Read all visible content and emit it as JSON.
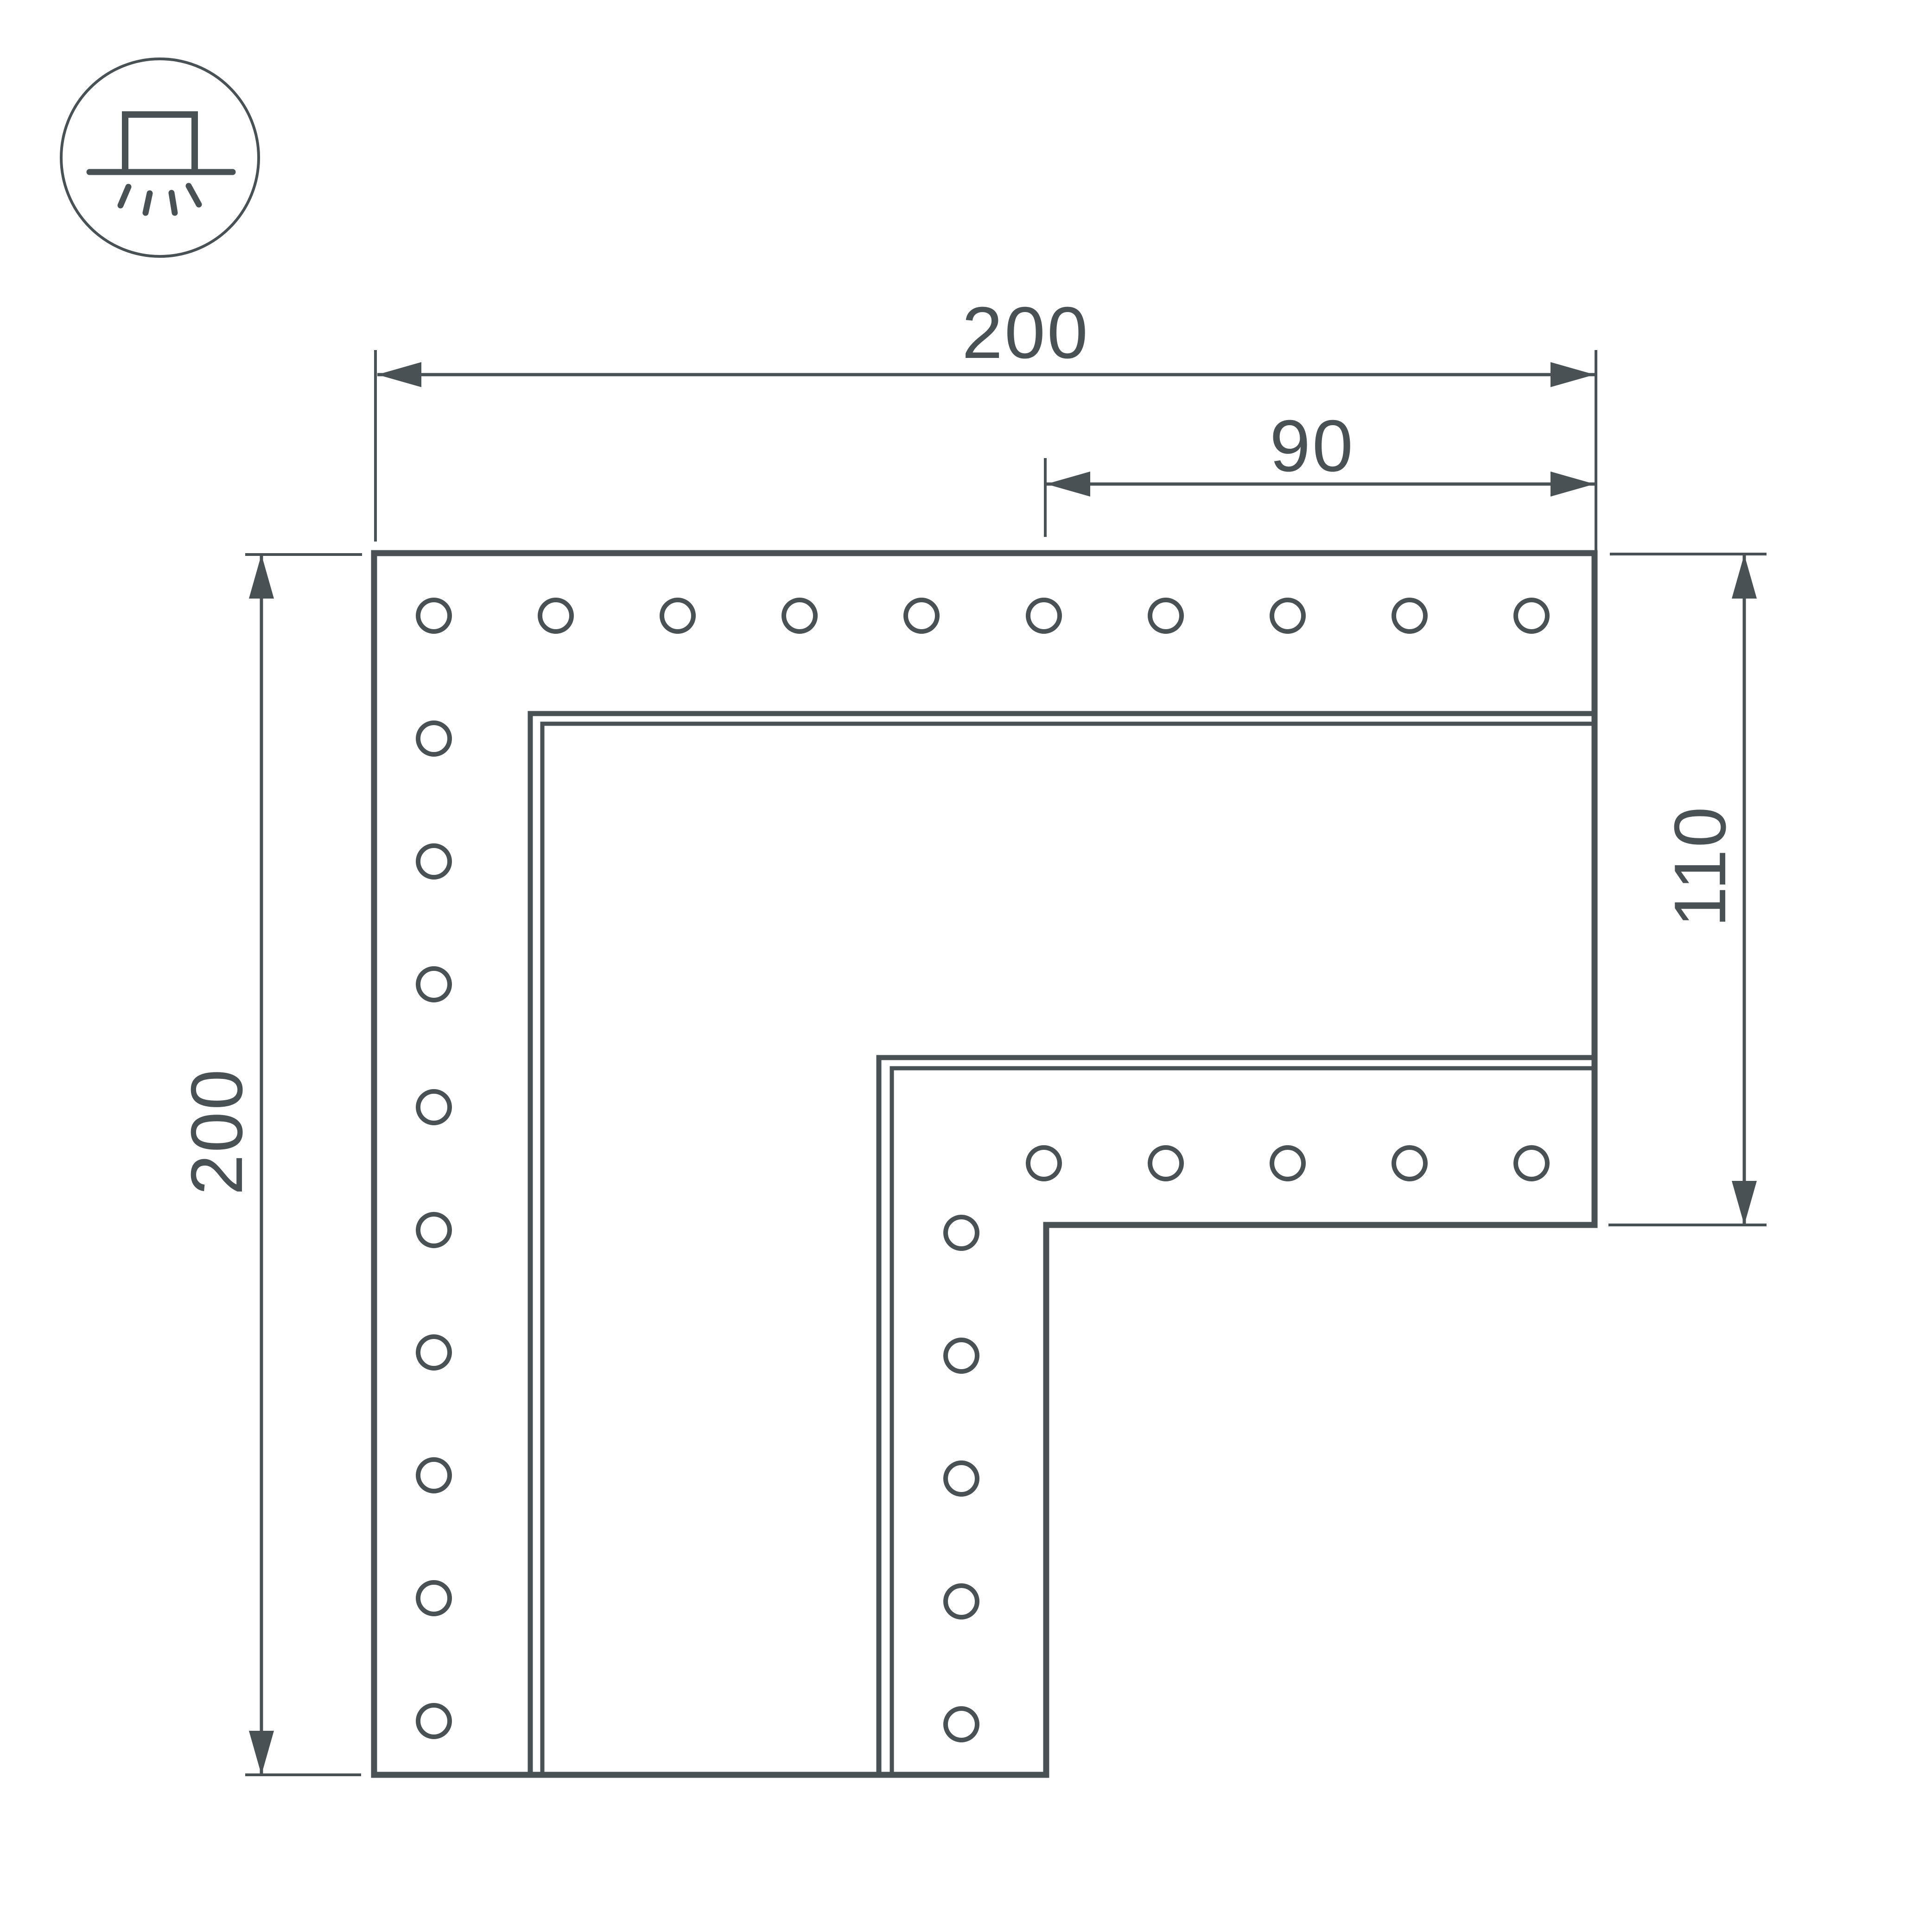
{
  "icon": {
    "name": "surface-mounted-luminaire-icon"
  },
  "dimensions": {
    "top_width": "200",
    "opening_width": "90",
    "left_height": "200",
    "right_height": "110"
  },
  "drawing": {
    "line_color": "#4a5155",
    "background_color": "#ffffff",
    "holes": {
      "top_row_count": 10,
      "left_column_count": 10,
      "inner_row_count": 5,
      "inner_column_count": 5
    }
  }
}
